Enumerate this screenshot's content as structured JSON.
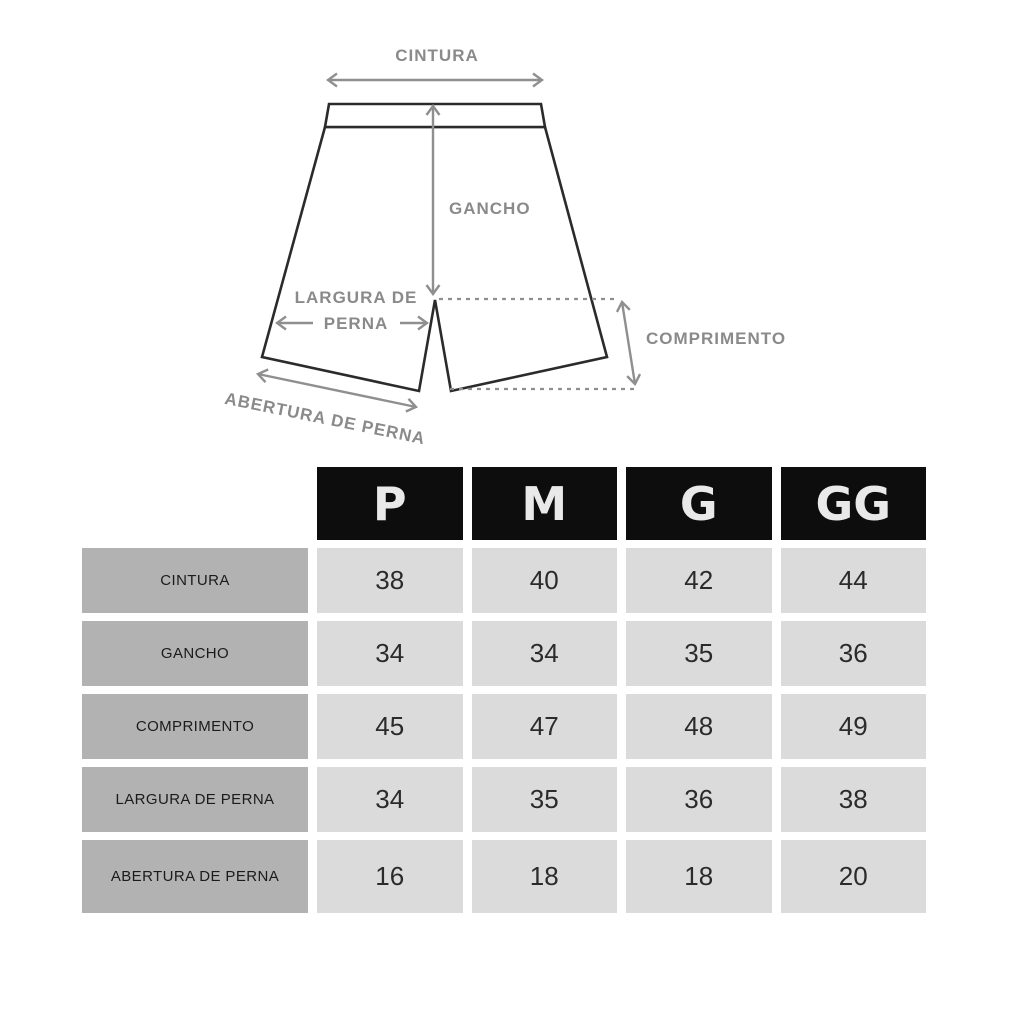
{
  "diagram": {
    "labels": {
      "cintura": "CINTURA",
      "gancho": "GANCHO",
      "largura_line1": "LARGURA DE",
      "largura_line2": "PERNA",
      "comprimento": "COMPRIMENTO",
      "abertura": "ABERTURA DE PERNA"
    },
    "colors": {
      "shorts_outline": "#2b2b2b",
      "annotation_gray": "#8f8f8f",
      "label_gray": "#8a8a8a"
    }
  },
  "table": {
    "columns": [
      "P",
      "M",
      "G",
      "GG"
    ],
    "rows": [
      {
        "label": "CINTURA",
        "values": [
          "38",
          "40",
          "42",
          "44"
        ]
      },
      {
        "label": "GANCHO",
        "values": [
          "34",
          "34",
          "35",
          "36"
        ]
      },
      {
        "label": "COMPRIMENTO",
        "values": [
          "45",
          "47",
          "48",
          "49"
        ]
      },
      {
        "label": "LARGURA DE PERNA",
        "values": [
          "34",
          "35",
          "36",
          "38"
        ]
      },
      {
        "label": "ABERTURA DE PERNA",
        "values": [
          "16",
          "18",
          "18",
          "20"
        ]
      }
    ],
    "colors": {
      "header_bg": "#0d0d0d",
      "header_text": "#e9e9e9",
      "label_bg": "#b2b2b2",
      "value_bg": "#dbdbdb"
    }
  }
}
